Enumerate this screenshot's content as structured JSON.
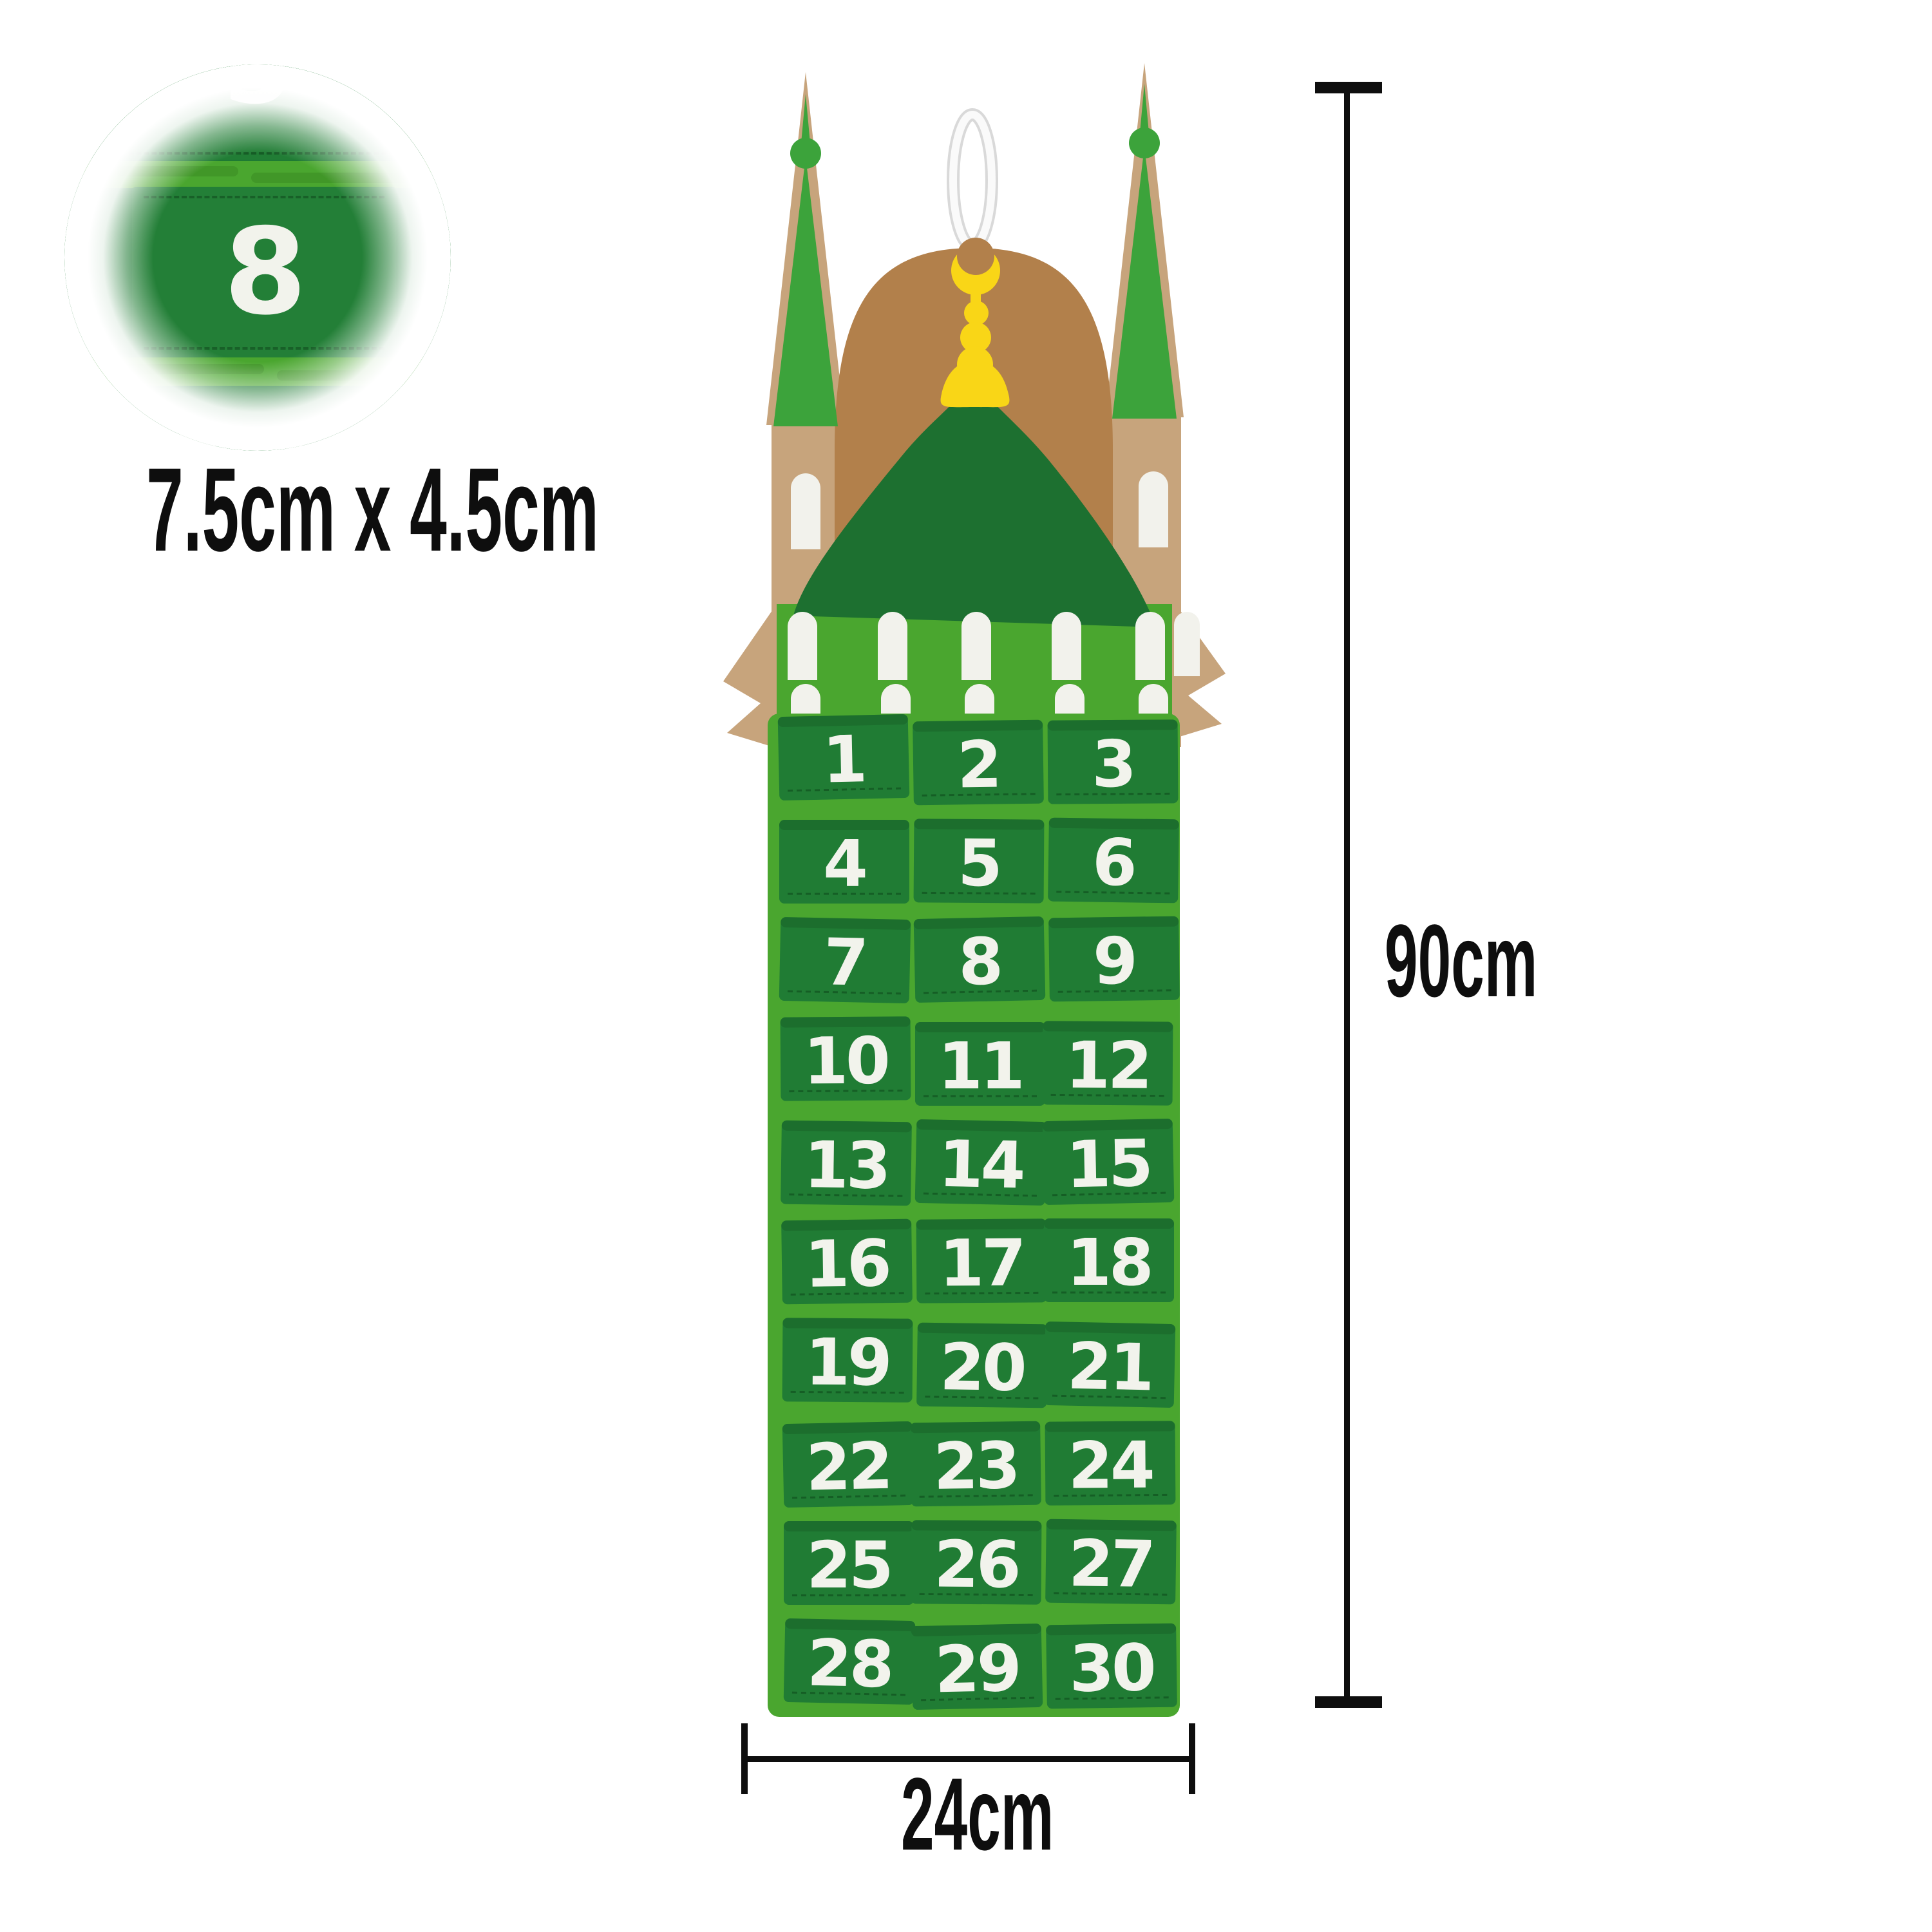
{
  "inset": {
    "zoomed_pocket_number": "8",
    "partial_top_number": "5",
    "partial_bottom_number": "11",
    "size_label": "7.5cm x 4.5cm"
  },
  "calendar": {
    "rows": 10,
    "columns": 3,
    "pocket_numbers": [
      "1",
      "2",
      "3",
      "4",
      "5",
      "6",
      "7",
      "8",
      "9",
      "10",
      "11",
      "12",
      "13",
      "14",
      "15",
      "16",
      "17",
      "18",
      "19",
      "20",
      "21",
      "22",
      "23",
      "24",
      "25",
      "26",
      "27",
      "28",
      "29",
      "30"
    ]
  },
  "dimensions": {
    "height_label": "90cm",
    "width_label": "24cm"
  },
  "colors": {
    "backing_dark_green": "#1e7a33",
    "band_lime": "#4aa62f",
    "pocket_green": "#207c34",
    "dome_green": "#1d7030",
    "spire_green": "#3ca33b",
    "arch_tan": "#b2804b",
    "tower_tan": "#c7a47c",
    "crescent_yellow": "#f9d617",
    "number_white": "#f2f3ec",
    "annotation_black": "#0e0e0e"
  }
}
